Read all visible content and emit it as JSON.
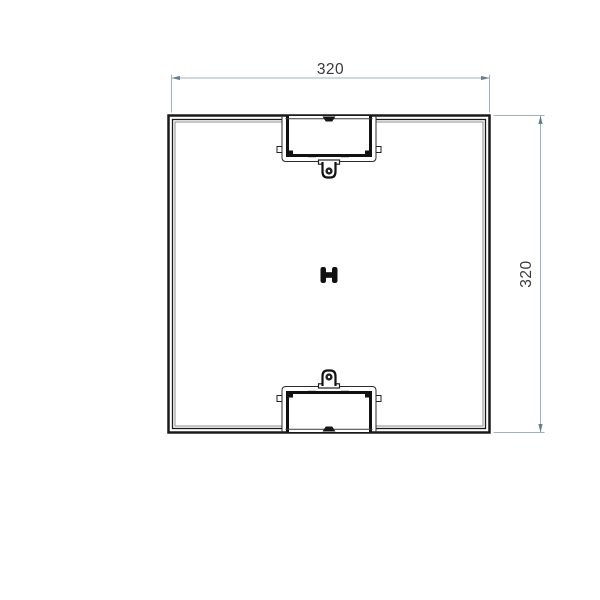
{
  "drawing": {
    "dim_width": {
      "label": "320"
    },
    "dim_height": {
      "label": "320"
    },
    "symbols": {
      "center_connector": "h-connector-symbol"
    },
    "colors": {
      "outline": "#1a1a1a",
      "inner_wall_line": "#8c8c8c",
      "notch_detail": "#111111",
      "dimension_line": "#9fb4bf",
      "dimension_accent": "#64808e",
      "dimension_text": "#3a3a3a",
      "background": "#ffffff"
    }
  }
}
